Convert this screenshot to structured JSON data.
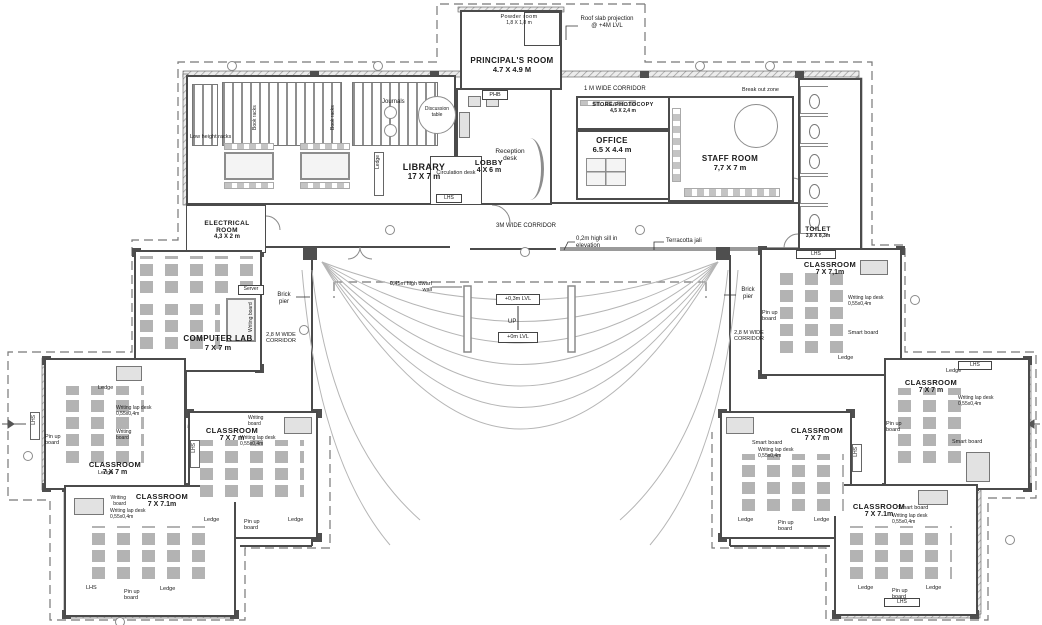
{
  "rooms": {
    "principal": {
      "name": "PRINCIPAL'S ROOM",
      "size": "4.7 X 4.9 M"
    },
    "powder": {
      "name": "Powder room",
      "size": "1,8 X 1,8 m"
    },
    "library": {
      "name": "LIBRARY",
      "size": "17 X 7 m"
    },
    "lobby": {
      "name": "LOBBY",
      "size": "4 X 6 m"
    },
    "store": {
      "name": "STORE/PHOTOCOPY",
      "size": "4,5 X 2,4 m"
    },
    "office": {
      "name": "OFFICE",
      "size": "6.5 X 4.4 m"
    },
    "staff": {
      "name": "STAFF ROOM",
      "size": "7,7 X 7 m"
    },
    "toilet": {
      "name": "TOILET",
      "size": "3,8 X 8,3m"
    },
    "electrical": {
      "name": "ELECTRICAL ROOM",
      "size": "4,3 X 2 m"
    },
    "computer_lab": {
      "name": "COMPUTER LAB",
      "size": "7 X 7 m"
    },
    "class_l1": {
      "name": "CLASSROOM",
      "size": "7 X 7 m"
    },
    "class_l2": {
      "name": "CLASSROOM",
      "size": "7 X 7 m"
    },
    "class_l3": {
      "name": "CLASSROOM",
      "size": "7 X 7.1m"
    },
    "class_r1": {
      "name": "CLASSROOM",
      "size": "7 X 7,1m"
    },
    "class_r2": {
      "name": "CLASSROOM",
      "size": "7 X 7 m"
    },
    "class_r3": {
      "name": "CLASSROOM",
      "size": "7 X 7 m"
    },
    "class_r4": {
      "name": "CLASSROOM",
      "size": "7 X 7.1m"
    }
  },
  "labels": {
    "roof_slab": "Roof slab projection @ +4M LVL",
    "phb": "PHB",
    "journals": "Journals",
    "discussion_table": "Discussion table",
    "low_height_racks": "Low height racks",
    "book_racks": "Book racks",
    "reception_desk": "Reception desk",
    "circulation_desk": "Circulation desk",
    "corridor_1m": "1 M WIDE CORRIDOR",
    "break_out_zone": "Break out zone",
    "corridor_3m": "3M WIDE CORRIDOR",
    "sill_note": "0,2m high sill in elevation",
    "terracotta_jali": "Terracotta jali",
    "dwarf_wall": "0,45m high dwarf wall",
    "lvl_plus03": "+0,3m LVL",
    "up": "UP",
    "lvl_0": "+0m LVL",
    "brick_pier": "Brick pier",
    "corridor_28m": "2,8 M WIDE CORRIDOR",
    "server": "Server",
    "writing_board": "Writing board",
    "pin_up_board": "Pin up board",
    "ledge": "Ledge",
    "lhs": "LHS",
    "lap_desk": "Writing lap desk 0,55x0,4m",
    "smart_board": "Smart board"
  }
}
